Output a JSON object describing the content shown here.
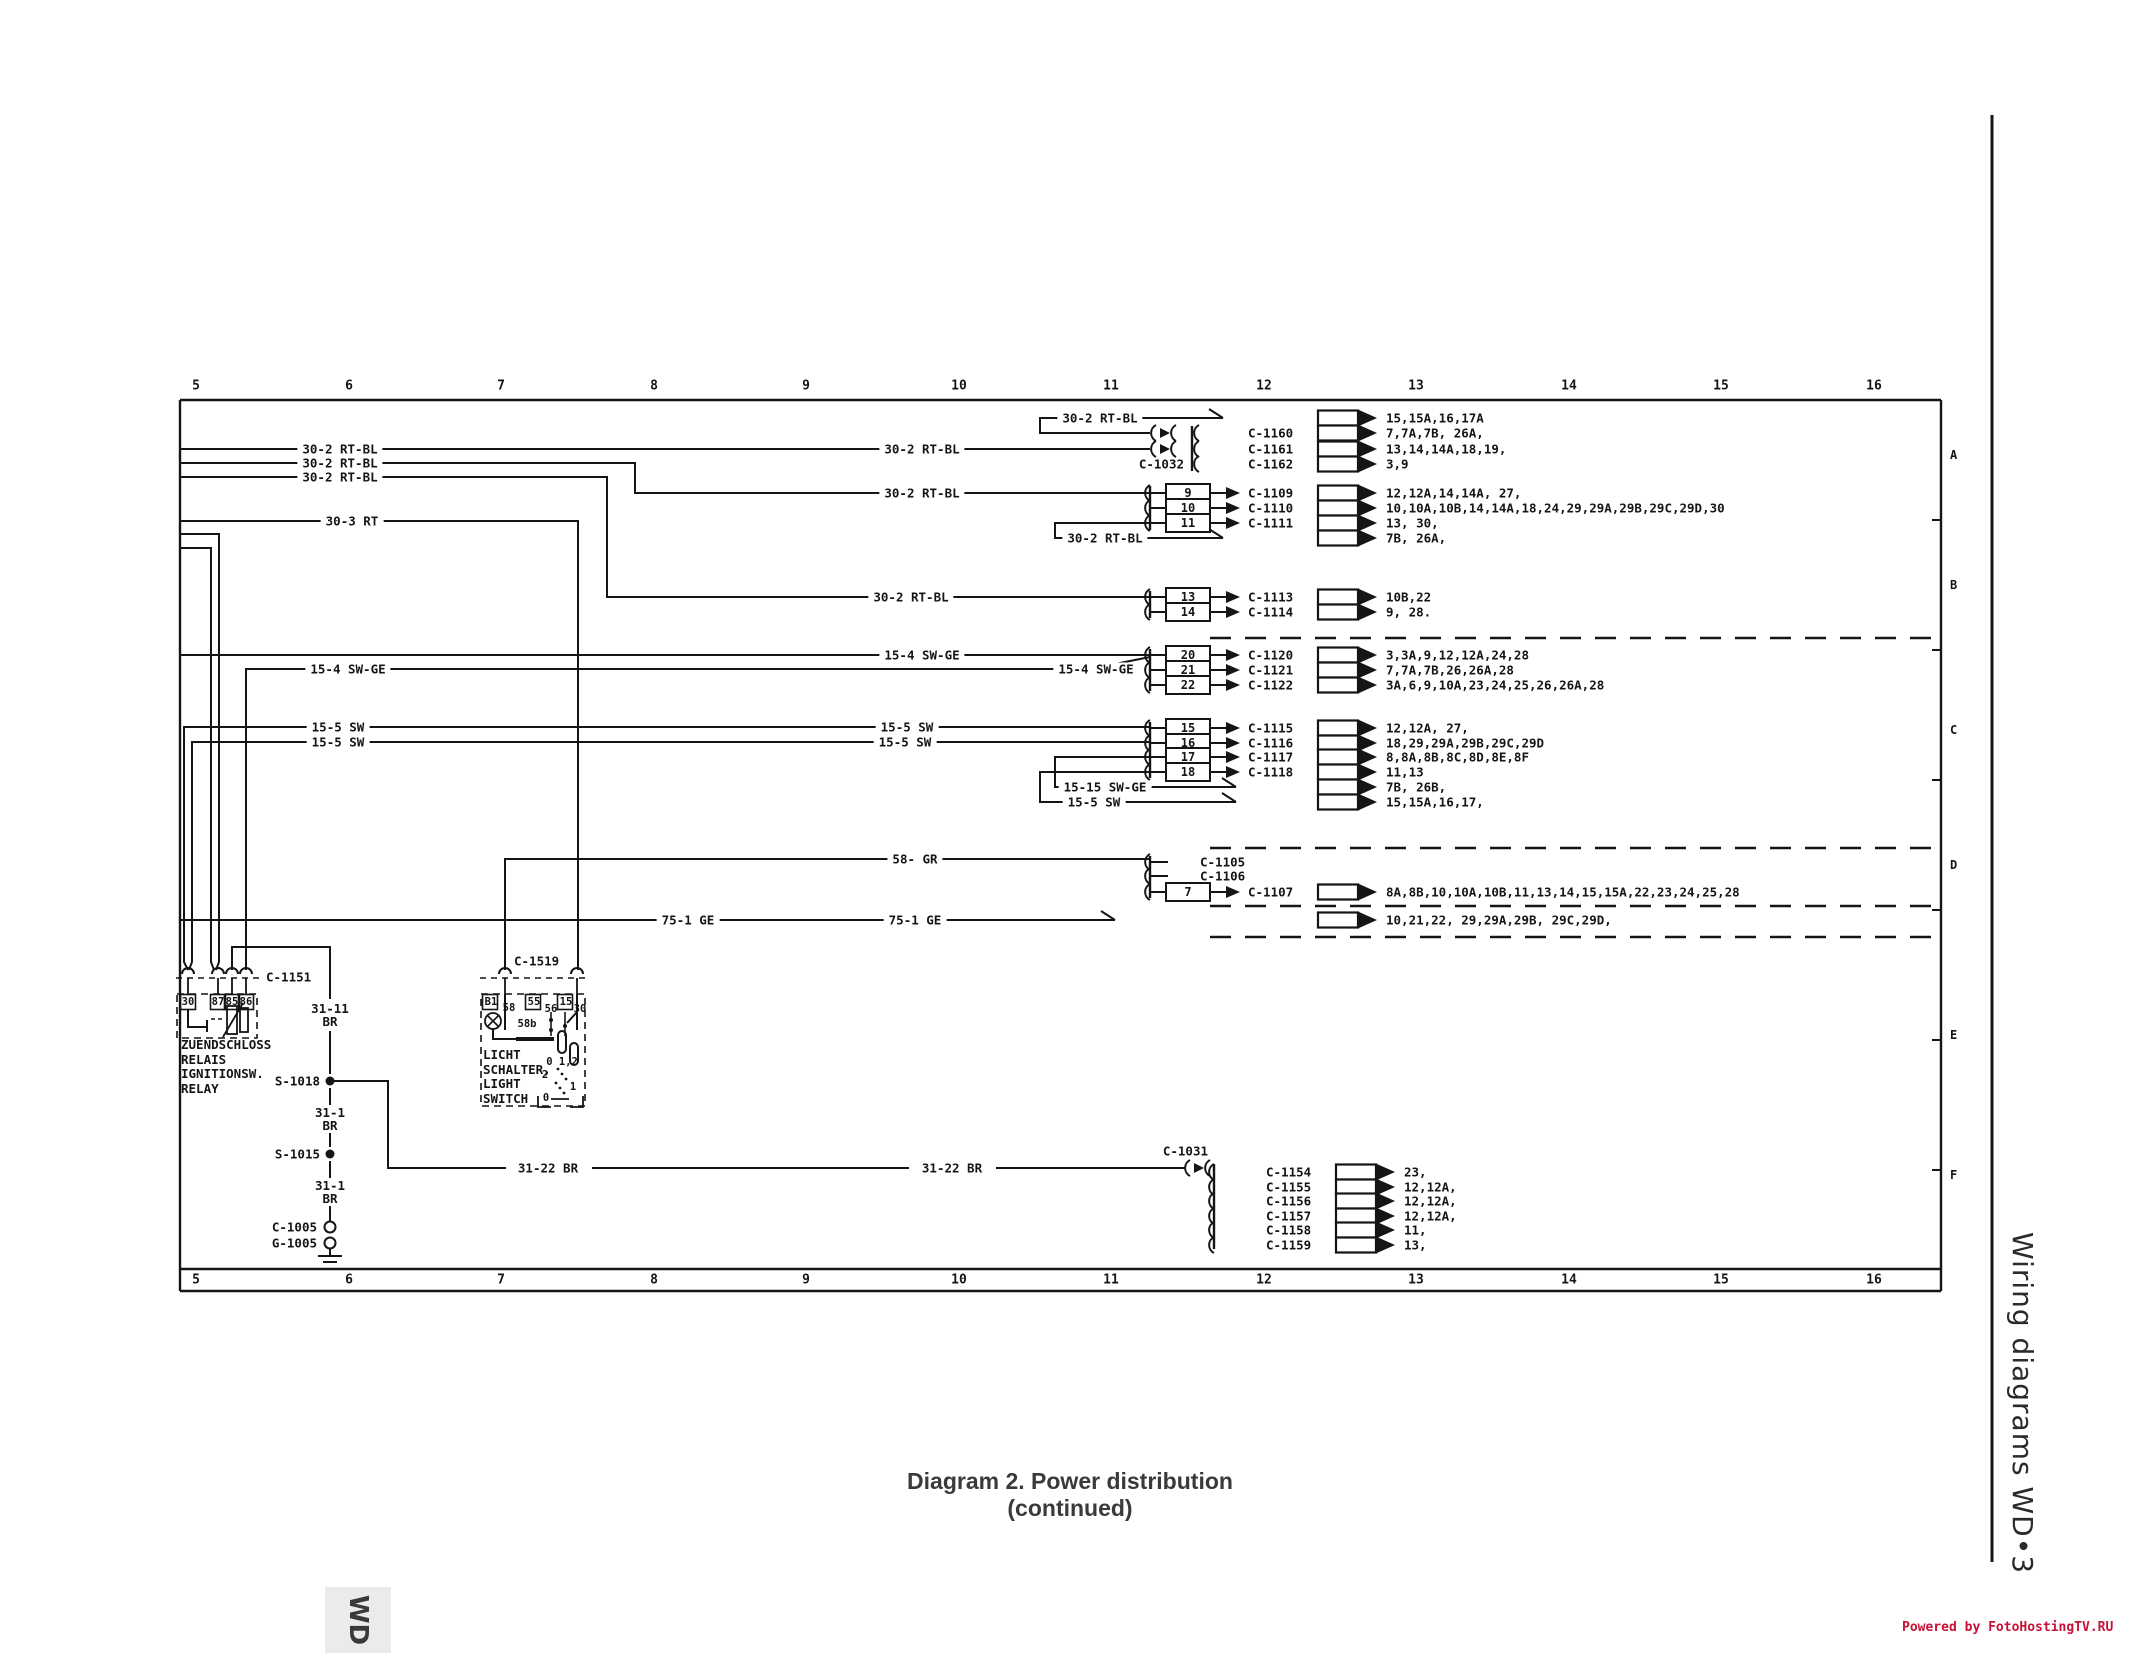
{
  "page": {
    "caption": "Diagram 2. Power distribution (continued)",
    "side_title": "Wiring diagrams  WD•3",
    "watermark": "Powered by FotoHostingTV.RU",
    "tab": "WD"
  },
  "grid": {
    "cols": [
      "5",
      "6",
      "7",
      "8",
      "9",
      "10",
      "11",
      "12",
      "13",
      "14",
      "15",
      "16"
    ],
    "rows": [
      "A",
      "B",
      "C",
      "D",
      "E",
      "F"
    ]
  },
  "wire_labels": {
    "rtbl": "30-2 RT-BL",
    "rt3": "30-3 RT",
    "swge4": "15-4 SW-GE",
    "sw5": "15-5 SW",
    "swge15": "15-15 SW-GE",
    "gr58": "58- GR",
    "ge75": "75-1 GE",
    "br3122": "31-22 BR",
    "br3111": "31-11\nBR",
    "br311": "31-1\nBR"
  },
  "rows": {
    "a1f": {
      "to": "15,15A,16,17A"
    },
    "a1r1": {
      "label": "C-1160",
      "to": "7,7A,7B, 26A,"
    },
    "a1r2": {
      "label": "C-1161",
      "to": "13,14,14A,18,19,"
    },
    "a1r3": {
      "label": "C-1162",
      "to": "3,9"
    },
    "a2r1": {
      "pin": "9",
      "label": "C-1109",
      "to": "12,12A,14,14A, 27,"
    },
    "a2r2": {
      "pin": "10",
      "label": "C-1110",
      "to": "10,10A,10B,14,14A,18,24,29,29A,29B,29C,29D,30"
    },
    "a2r3": {
      "pin": "11",
      "label": "C-1111",
      "to": "13, 30,"
    },
    "a2f": {
      "to": "7B, 26A,"
    },
    "br1": {
      "pin": "13",
      "label": "C-1113",
      "to": "10B,22"
    },
    "br2": {
      "pin": "14",
      "label": "C-1114",
      "to": "9, 28."
    },
    "c1r1": {
      "pin": "20",
      "label": "C-1120",
      "to": "3,3A,9,12,12A,24,28"
    },
    "c1r2": {
      "pin": "21",
      "label": "C-1121",
      "to": "7,7A,7B,26,26A,28"
    },
    "c1r3": {
      "pin": "22",
      "label": "C-1122",
      "to": "3A,6,9,10A,23,24,25,26,26A,28"
    },
    "c2r1": {
      "pin": "15",
      "label": "C-1115",
      "to": "12,12A, 27,"
    },
    "c2r2": {
      "pin": "16",
      "label": "C-1116",
      "to": "18,29,29A,29B,29C,29D"
    },
    "c2r3": {
      "pin": "17",
      "label": "C-1117",
      "to": "8,8A,8B,8C,8D,8E,8F"
    },
    "c2r4": {
      "pin": "18",
      "label": "C-1118",
      "to": "11,13"
    },
    "c2f1": {
      "to": "7B, 26B,"
    },
    "c2f2": {
      "to": "15,15A,16,17,"
    },
    "dr1": {
      "label": "C-1105"
    },
    "dr2": {
      "label": "C-1106"
    },
    "dr3": {
      "pin": "7",
      "label": "C-1107",
      "to": "8A,8B,10,10A,10B,11,13,14,15,15A,22,23,24,25,28"
    },
    "df": {
      "to": "10,21,22, 29,29A,29B, 29C,29D,"
    },
    "fr1": {
      "label": "C-1154",
      "to": "23,"
    },
    "fr2": {
      "label": "C-1155",
      "to": "12,12A,"
    },
    "fr3": {
      "label": "C-1156",
      "to": "12,12A,"
    },
    "fr4": {
      "label": "C-1157",
      "to": "12,12A,"
    },
    "fr5": {
      "label": "C-1158",
      "to": "11,"
    },
    "fr6": {
      "label": "C-1159",
      "to": "13,"
    }
  },
  "components": {
    "relay": {
      "connector": "C-1151",
      "t30": "30",
      "t87": "87",
      "t85": "85",
      "t86": "86",
      "name": "ZUENDSCHLOSS\nRELAIS\nIGNITIONSW.\nRELAY"
    },
    "light_switch": {
      "connector": "C-1519",
      "tb1": "B1",
      "t58": "58",
      "t55": "55",
      "t56": "56",
      "t15": "15",
      "t30": "30",
      "t58b": "58b",
      "pos_top": "0 1,2",
      "pos2": "2",
      "pos1": "1",
      "pos0": "0",
      "name": "LICHT\nSCHALTER,\nLIGHT\nSWITCH"
    },
    "labels": {
      "c1032": "C-1032",
      "c1031": "C-1031",
      "s1018": "S-1018",
      "s1015": "S-1015",
      "c1005": "C-1005",
      "g1005": "G-1005"
    }
  }
}
